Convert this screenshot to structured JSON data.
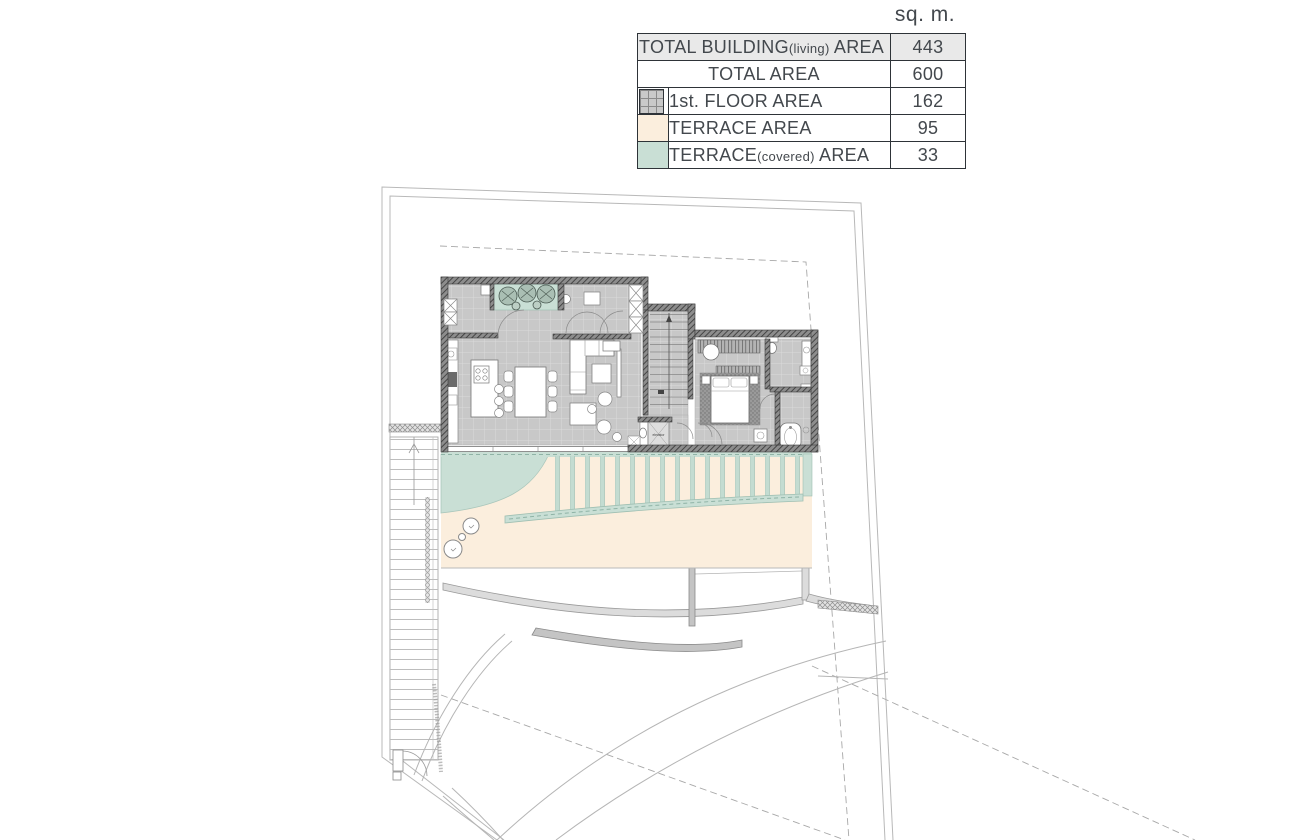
{
  "unit_header": "sq. m.",
  "area_table": {
    "rows": [
      {
        "label_main": "TOTAL BUILDING",
        "label_paren": "(living)",
        "label_suffix": " AREA",
        "value": "443",
        "swatch": "none"
      },
      {
        "label_main": "TOTAL AREA",
        "label_paren": "",
        "label_suffix": "",
        "value": "600",
        "swatch": "none"
      },
      {
        "label_main": "1st. FLOOR AREA",
        "label_paren": "",
        "label_suffix": "",
        "value": "162",
        "swatch": "floor"
      },
      {
        "label_main": "TERRACE AREA",
        "label_paren": "",
        "label_suffix": "",
        "value": "95",
        "swatch": "terrace"
      },
      {
        "label_main": "TERRACE",
        "label_paren": "(covered)",
        "label_suffix": " AREA",
        "value": "33",
        "swatch": "terrace_covered"
      }
    ]
  },
  "colors": {
    "terrace": "#fbeedd",
    "terrace_covered": "#c9dfd5",
    "floor_swatch": "#c9c9c9"
  },
  "plan": {
    "elevator_label": "elevator"
  }
}
